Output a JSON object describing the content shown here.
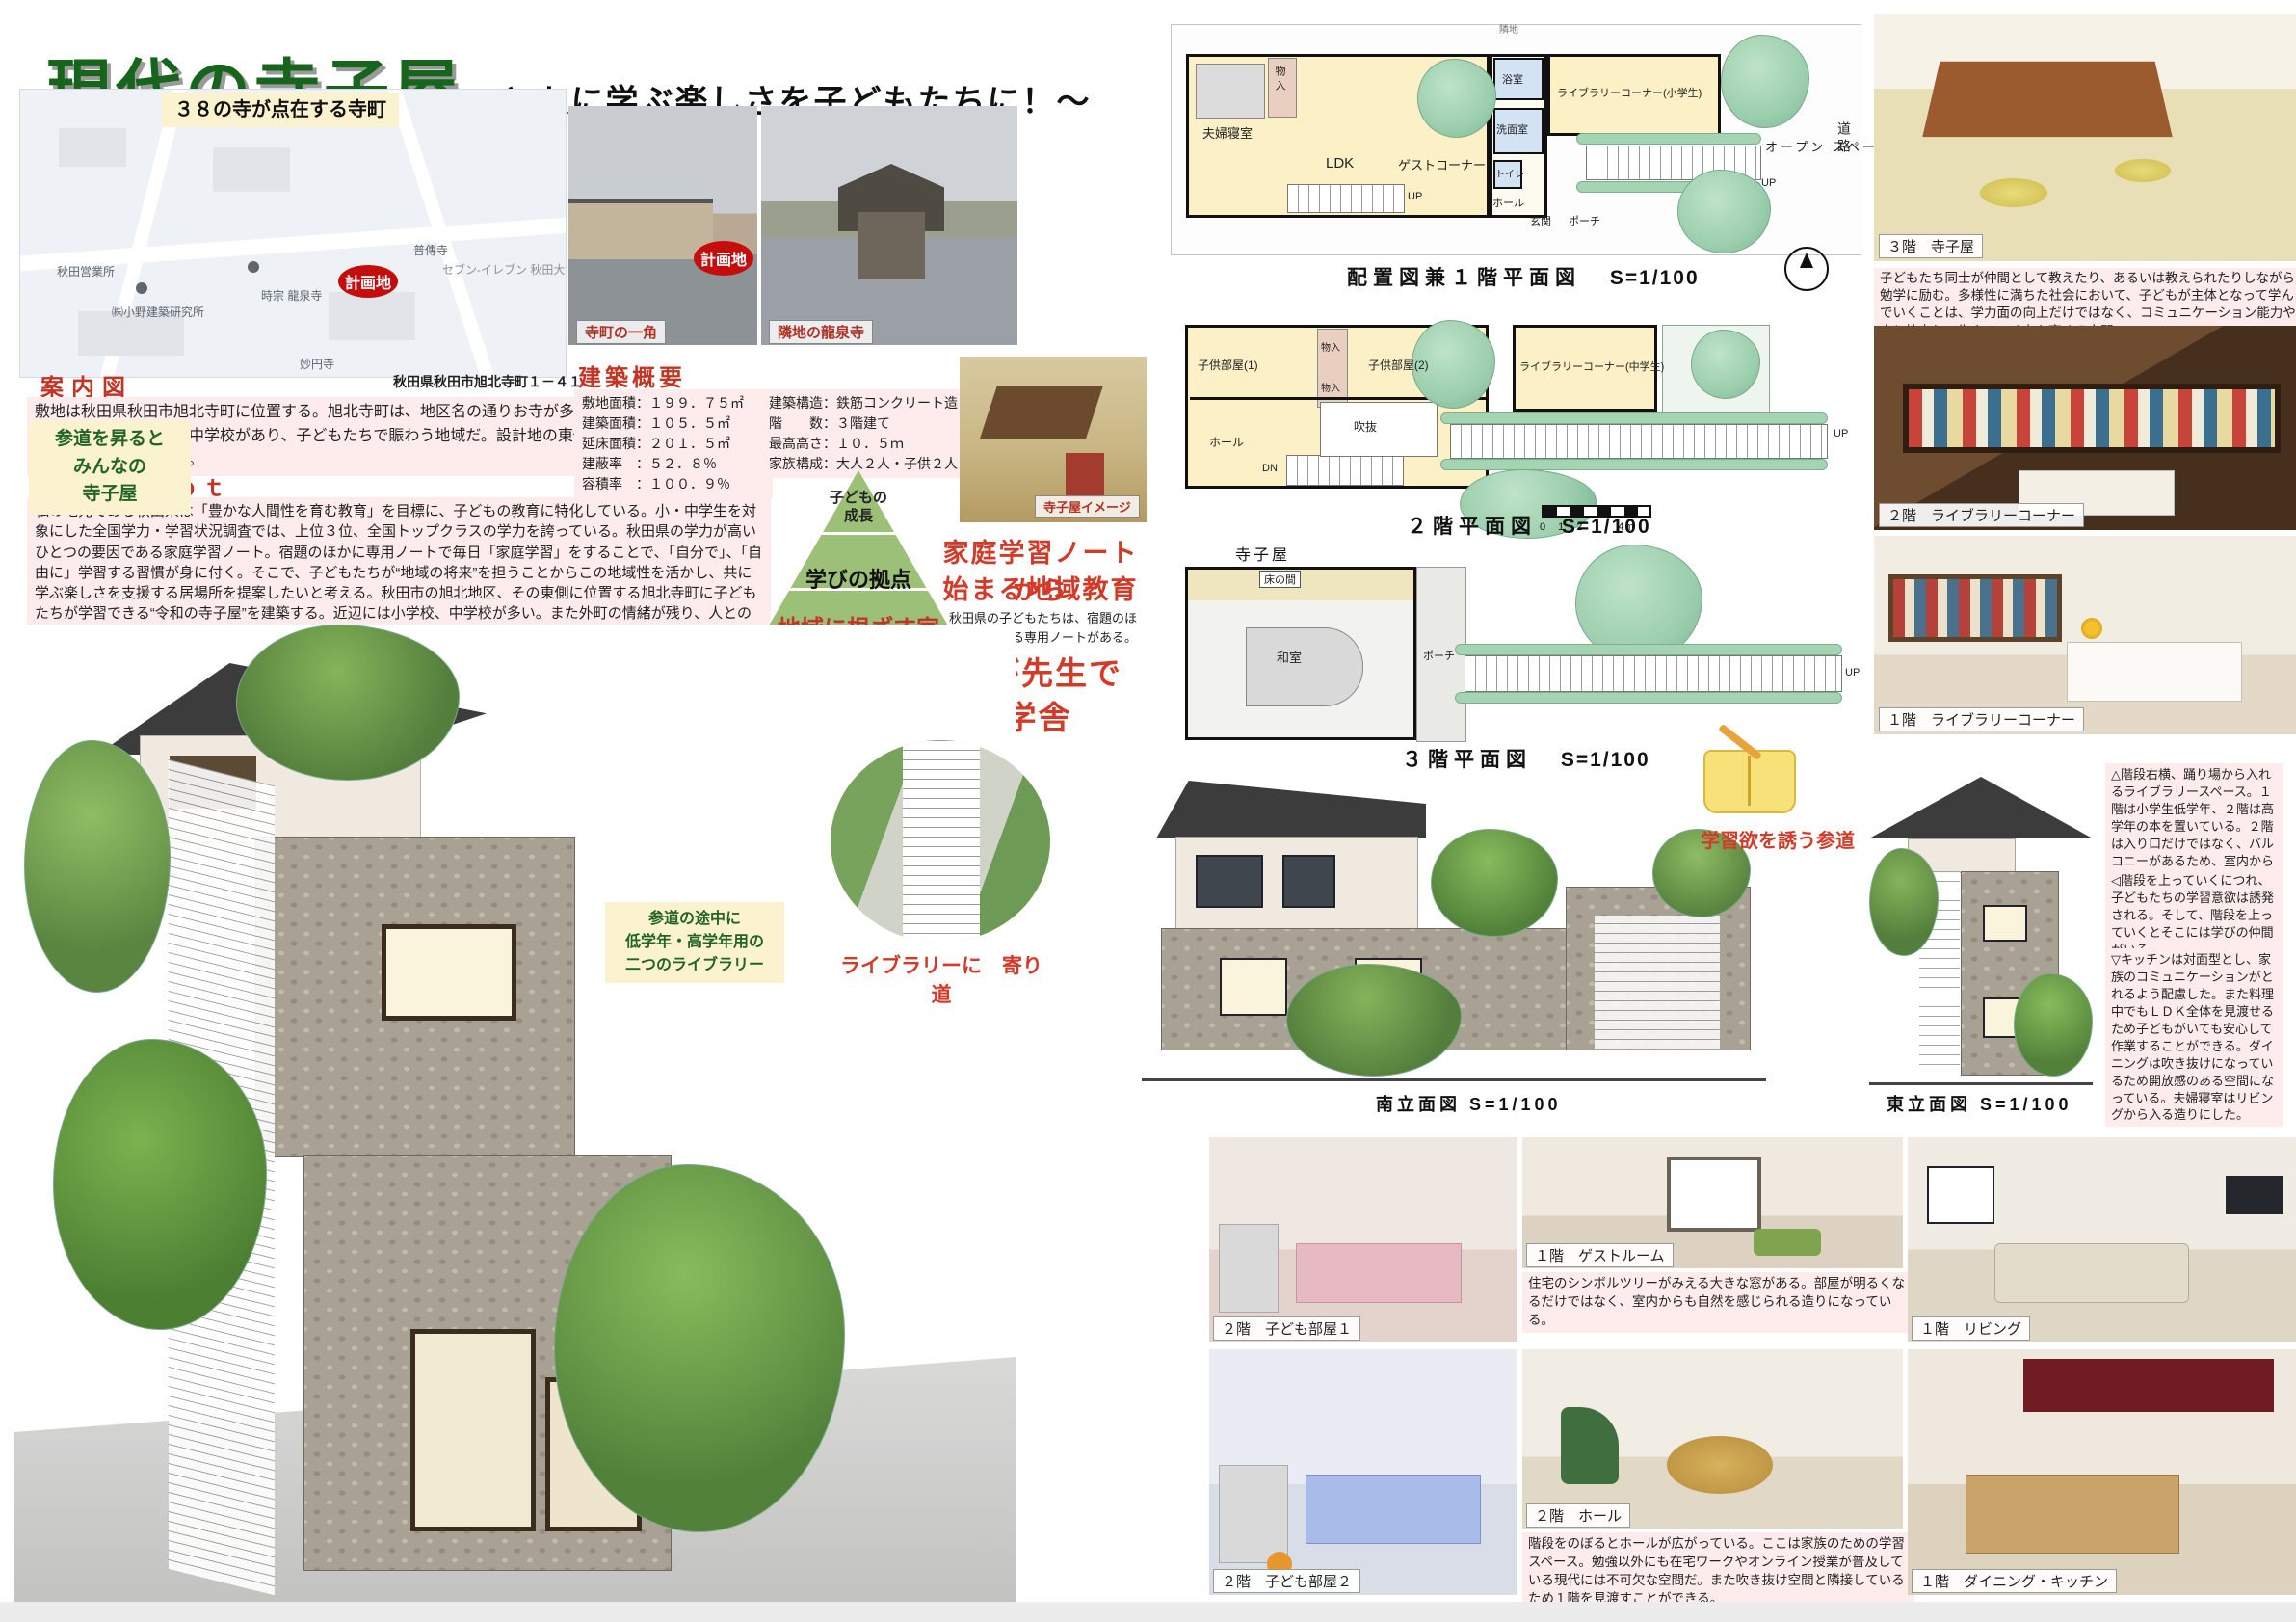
{
  "title": {
    "main": "現代の寺子屋",
    "subtitle": "～ともに学ぶ楽しさを子どもたちに！～"
  },
  "map": {
    "banner": "３８の寺が点在する寺町",
    "site_label": "計画地",
    "address": "秋田県秋田市旭北寺町１－４１",
    "labels": {
      "office": "秋田営業所",
      "lab": "㈱小野建築研究所",
      "ryusenji": "時宗 龍泉寺",
      "fudenji": "普傳寺",
      "seven": "セブン-イレブン\n秋田大町4丁目店\nコンビニエンスストア",
      "myoenji": "妙円寺"
    }
  },
  "photos": {
    "street_caption": "寺町の一角",
    "street_site_label": "計画地",
    "temple_caption": "隣地の龍泉寺",
    "terakoya_caption": "寺子屋イメージ"
  },
  "guide": {
    "heading": "案内図",
    "body": "敷地は秋田県秋田市旭北寺町に位置する。旭北寺町は、地区名の通りお寺が多く、一列に並んでいる。また近隣には小学校や中学校があり、子どもたちで賑わう地域だ。設計地の東側は道路で、西側及び南側はお寺になっている。"
  },
  "concept": {
    "heading": "Ｃｏｎｃｅｐｔ",
    "body": "私の地元である秋田県は「豊かな人間性を育む教育」を目標に、子どもの教育に特化している。小・中学生を対象にした全国学力・学習状況調査では、上位３位、全国トップクラスの学力を誇っている。秋田県の学力が高いひとつの要因である家庭学習ノート。宿題のほかに専用ノートで毎日「家庭学習」をすることで、「自分で」、「自由に」学習する習慣が身に付く。そこで、子どもたちが“地域の将来”を担うことからこの地域性を活かし、共に学ぶ楽しさを支援する居場所を提案したいと考える。秋田市の旭北地区、その東側に位置する旭北寺町に子どもたちが学習できる“令和の寺子屋”を建築する。近辺には小学校、中学校が多い。また外町の情緒が残り、人との関わりが濃厚だ。「まちのみんなが先生で、まち全体が学舎」という理念を掲げ、まちの人々と一緒に子どもが勉強だけでなく、様々な物事や生活を楽しむ思考を身に付ける環境を提供したい。"
  },
  "overview": {
    "heading": "建築概要",
    "left": [
      "敷地面積：１９９．７５㎡",
      "建築面積：１０５．５㎡",
      "延床面積：２０１．５㎡",
      "建蔽率　：５２．８％",
      "容積率　：１００．９％"
    ],
    "right": [
      "建築構造：鉄筋コンクリート造",
      "階　　数：３階建て",
      "最高高さ：１０．５ｍ",
      "家族構成：大人２人・子供２人"
    ]
  },
  "pyramid": {
    "top": "子どもの\n成長",
    "middle": "学びの拠点",
    "bottom": "地域に根ざす家"
  },
  "home_note": {
    "line1": "家庭学習ノートから",
    "line2": "始まる地域教育",
    "note": "秋田県の子どもたちは、宿題のほかに学習する専用ノートがある。"
  },
  "main_slogan": {
    "line1": "地域のみんなが先生で",
    "line2": "まち全体が学舎"
  },
  "bubbles": {
    "approach": "参道を昇ると\nみんなの\n寺子屋",
    "libraries": "参道の途中に\n低学年・高学年用の\n二つのライブラリー",
    "detour": "ライブラリーに　寄り道",
    "approach_slogan": "学習欲を誘う参道"
  },
  "plans": {
    "f1": {
      "caption": "配置図兼１階平面図",
      "scale": "S=1/100",
      "rooms": [
        "夫婦寝室",
        "物入",
        "LDK",
        "ゲストコーナー",
        "浴室",
        "洗面室",
        "トイレ",
        "ホール",
        "玄関",
        "ポーチ",
        "ライブラリーコーナー(小学生)",
        "オープン\nスペース",
        "UP",
        "道路",
        "隣地"
      ]
    },
    "f2": {
      "caption": "２階平面図",
      "scale": "S=1/100",
      "rooms": [
        "子供部屋(1)",
        "物入",
        "物入",
        "子供部屋(2)",
        "ライブラリーコーナー(中学生)",
        "ホール",
        "吹抜",
        "DN",
        "UP"
      ],
      "scalebar": "0　1　2　　　4m"
    },
    "f3": {
      "caption": "３階平面図",
      "scale": "S=1/100",
      "title": "寺子屋",
      "rooms": [
        "床の間",
        "和室",
        "ポーチ",
        "UP"
      ]
    },
    "south": {
      "caption": "南立面図 S=1/100"
    },
    "east": {
      "caption": "東立面図 S=1/100"
    }
  },
  "renders": {
    "terakoya": {
      "caption": "３階　寺子屋",
      "body": "子どもたち同士が仲間として教えたり、あるいは教えられたりしながら勉学に励む。多様性に満ちた社会において、子どもが主体となって学んでいくことは、学力面の向上だけではなく、コミュニケーション能力や人と協力して生きていく力を育める空間。"
    },
    "lib2f": {
      "caption": "２階　ライブラリーコーナー"
    },
    "lib1f": {
      "caption": "１階　ライブラリーコーナー"
    },
    "child1": {
      "caption": "２階　子ども部屋１"
    },
    "guest": {
      "caption": "１階　ゲストルーム",
      "body": "住宅のシンボルツリーがみえる大きな窓がある。部屋が明るくなるだけではなく、室内からも自然を感じられる造りになっている。"
    },
    "living": {
      "caption": "１階　リビング"
    },
    "child2": {
      "caption": "２階　子ども部屋２"
    },
    "hall": {
      "caption": "２階　ホール",
      "body": "階段をのぼるとホールが広がっている。ここは家族のための学習スペース。勉強以外にも在宅ワークやオンライン授業が普及している現代には不可欠な空間だ。また吹き抜け空間と隣接しているため１階を見渡すことができる。"
    },
    "dining": {
      "caption": "１階　ダイニング・キッチン"
    }
  },
  "notes": {
    "library": "△階段右横、踊り場から入れるライブラリースペース。１階は小学生低学年、２階は高学年の本を置いている。２階は入り口だけではなく、バルコニーがあるため、室内からも自然を感じられる造りになっている。",
    "stairs": "◁階段を上っていくにつれ、子どもたちの学習意欲は誘発される。そして、階段を上っていくとそこには学びの仲間がいる。",
    "kitchen": "▽キッチンは対面型とし、家族のコミュニケーションがとれるよう配慮した。また料理中でもＬＤＫ全体を見渡せるため子どもがいても安心して作業することができる。ダイニングは吹き抜けになっているため開放感のある空間になっている。夫婦寝室はリビングから入る造りにした。"
  },
  "colors": {
    "accent_green": "#17641c",
    "accent_red": "#d33a28",
    "pink_bg": "#fdeceb",
    "cream_bg": "#fbf3cf"
  }
}
